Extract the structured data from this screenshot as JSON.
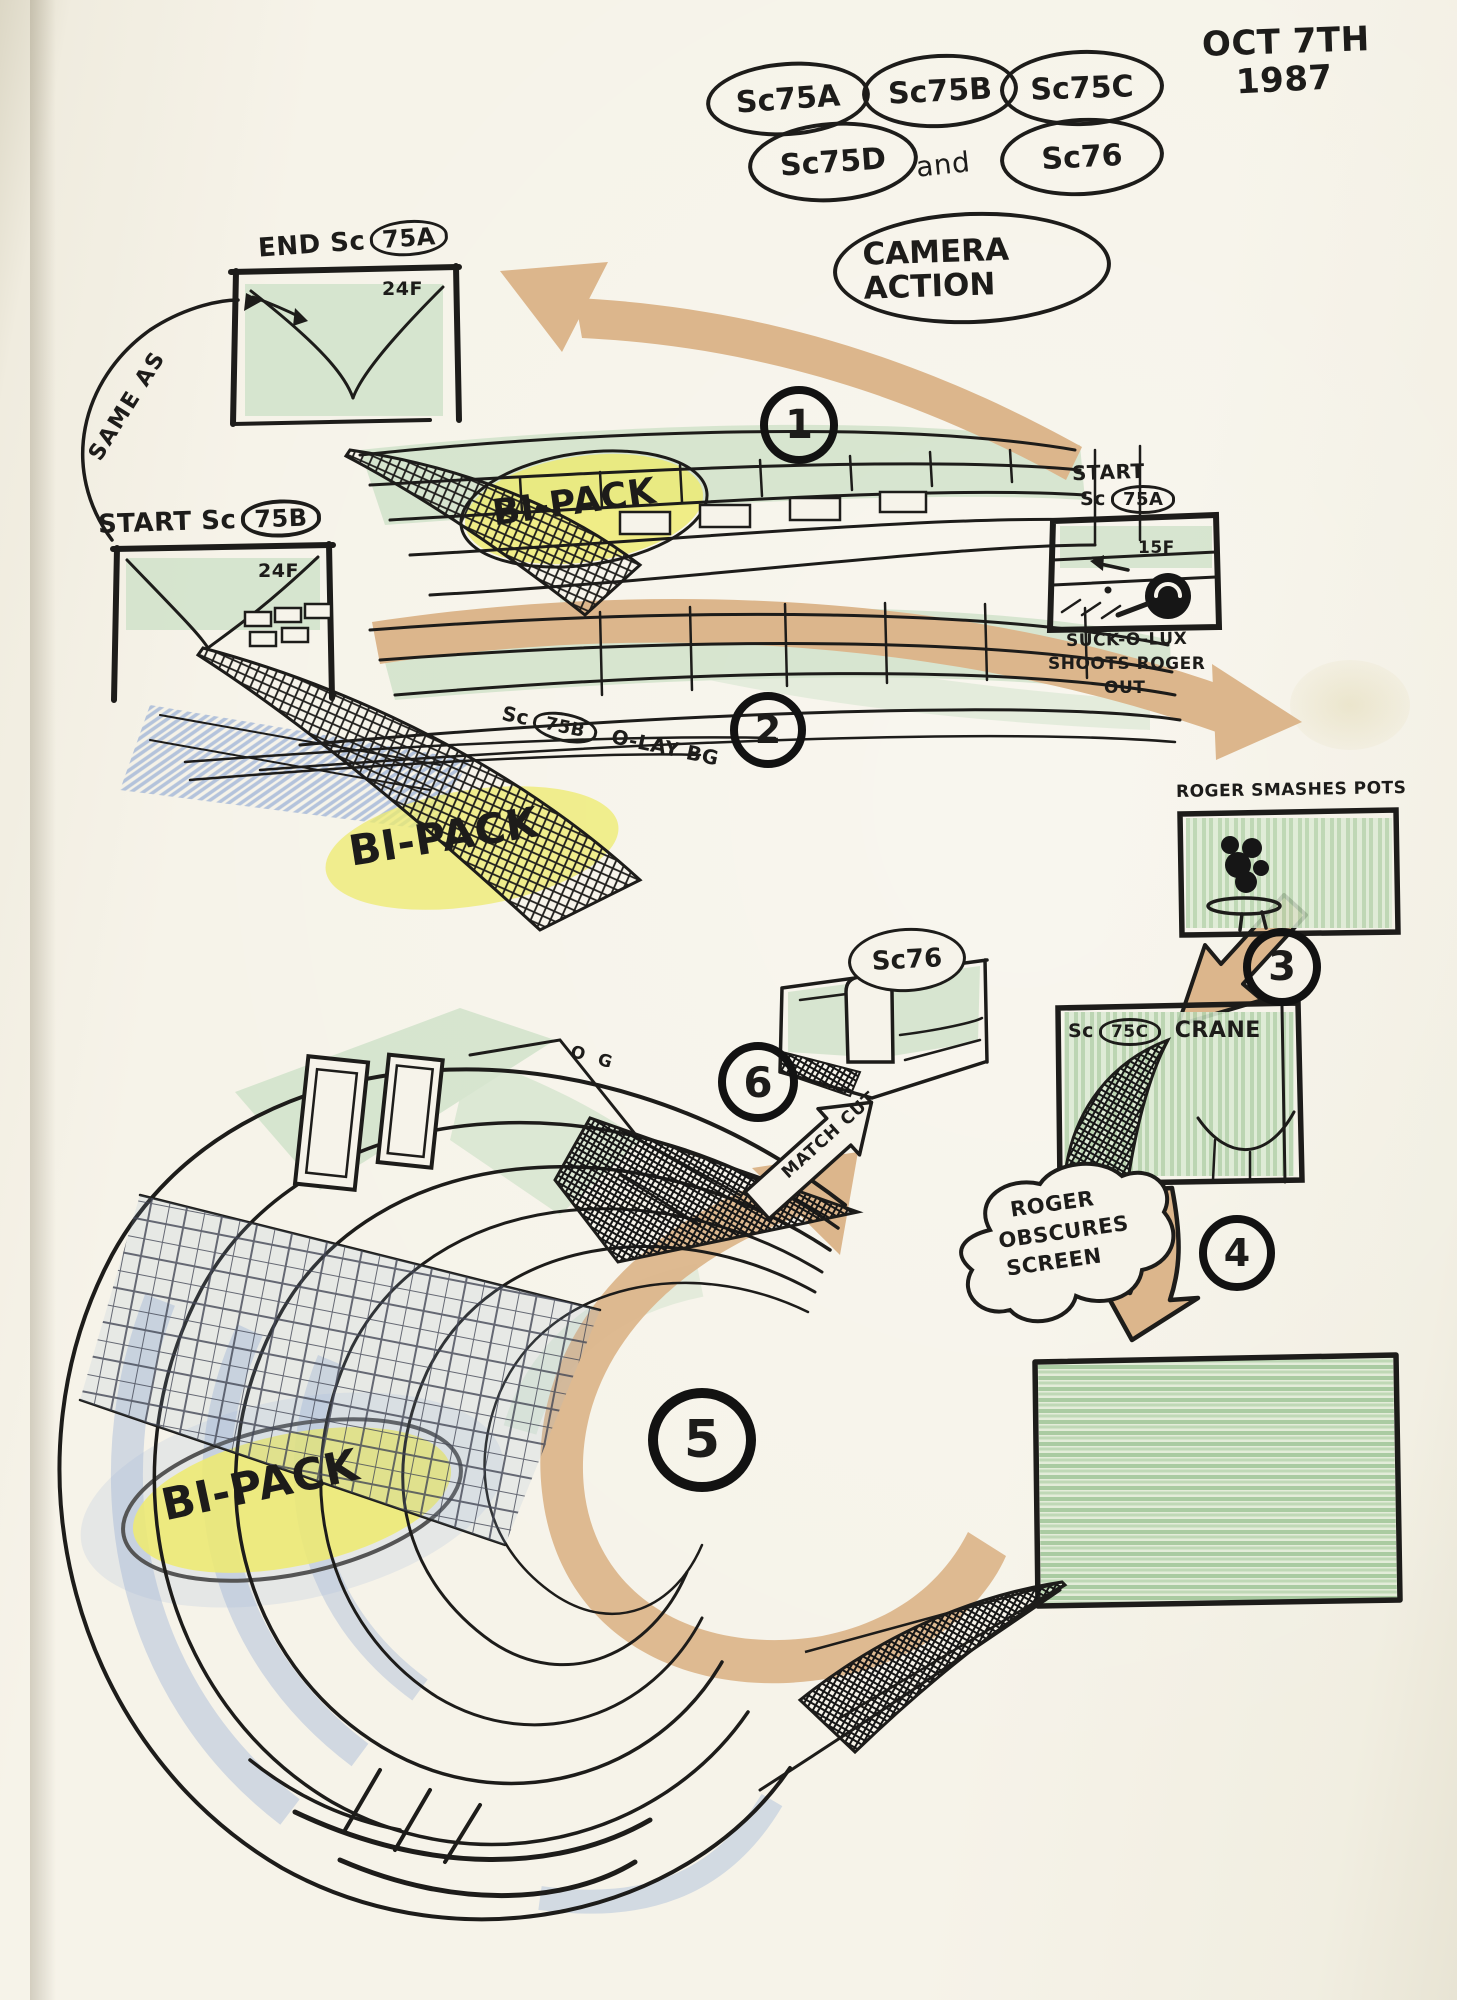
{
  "meta": {
    "date_line1": "OCT 7TH",
    "date_line2": "1987"
  },
  "scenes": {
    "a": "Sc75A",
    "b": "Sc75B",
    "c": "Sc75C",
    "d": "Sc75D",
    "conj": "and",
    "s76": "Sc76"
  },
  "title": {
    "line1": "CAMERA",
    "line2": "ACTION"
  },
  "panel_end_75a": {
    "prefix": "END Sc",
    "circled": "75A",
    "frame": "24F"
  },
  "panel_start_75b": {
    "prefix": "START Sc",
    "circled": "75B",
    "frame": "24F"
  },
  "panel_start_75a": {
    "line1": "START",
    "prefix": "Sc",
    "circled": "75A",
    "frame": "15F",
    "caption1": "SUCK-O-LUX",
    "caption2": "SHOOTS ROGER",
    "caption3": "OUT"
  },
  "same_as": "SAME AS",
  "overlay_label": {
    "prefix": "Sc",
    "circled": "75B",
    "rest": "O-LAY BG"
  },
  "bipack": "BI-PACK",
  "steps": {
    "n1": "1",
    "n2": "2",
    "n3": "3",
    "n4": "4",
    "n5": "5",
    "n6": "6"
  },
  "roger_smashes_pots": "ROGER SMASHES POTS",
  "sc76_label": "Sc76",
  "crane_label": {
    "prefix": "Sc",
    "circled": "75C",
    "rest": "CRANE"
  },
  "match_cut": "MATCH CUT",
  "cloud": {
    "line1": "ROGER",
    "line2": "OBSCURES",
    "line3": "SCREEN"
  },
  "og": "O G",
  "colors": {
    "ink": "#1d1c1a",
    "tan": "#dcb68c",
    "green": "#cfe2c9",
    "yellow": "#eeeb6e",
    "blue": "#9db3d6",
    "paper": "#f4f1e6"
  }
}
